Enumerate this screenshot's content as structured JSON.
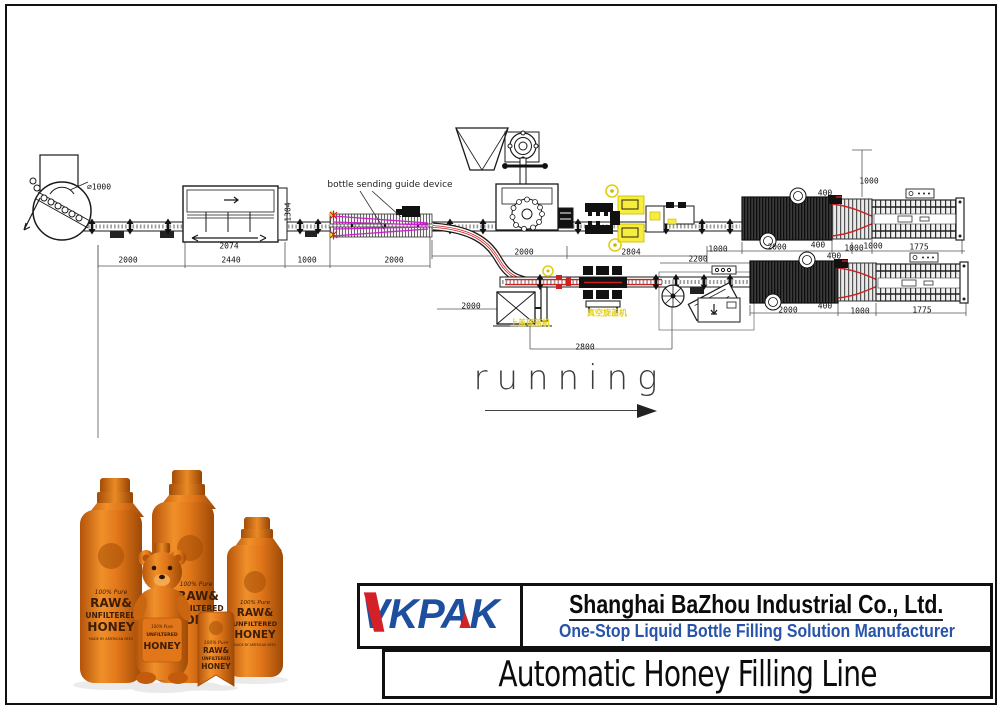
{
  "diagram": {
    "labels": {
      "turntable_diameter": "⌀1000",
      "guide_device": "bottle sending guide device",
      "cap_feeder_cn": "上盖理盖机",
      "vacuum_capper_cn": "真空旋盖机",
      "running": "running"
    },
    "dimensions": [
      {
        "t": "2000",
        "x": 128,
        "y": 260
      },
      {
        "t": "2440",
        "x": 231,
        "y": 260
      },
      {
        "t": "2074",
        "x": 229,
        "y": 246
      },
      {
        "t": "1304",
        "x": 288,
        "y": 212,
        "r": -90
      },
      {
        "t": "1000",
        "x": 307,
        "y": 260
      },
      {
        "t": "2000",
        "x": 394,
        "y": 260
      },
      {
        "t": "2000",
        "x": 524,
        "y": 252
      },
      {
        "t": "2804",
        "x": 631,
        "y": 252
      },
      {
        "t": "2200",
        "x": 698,
        "y": 259
      },
      {
        "t": "1000",
        "x": 718,
        "y": 249
      },
      {
        "t": "2000",
        "x": 777,
        "y": 247
      },
      {
        "t": "400",
        "x": 818,
        "y": 245
      },
      {
        "t": "1000",
        "x": 854,
        "y": 248
      },
      {
        "t": "1000",
        "x": 873,
        "y": 246
      },
      {
        "t": "1775",
        "x": 919,
        "y": 247
      },
      {
        "t": "1000",
        "x": 869,
        "y": 181
      },
      {
        "t": "400",
        "x": 825,
        "y": 193
      },
      {
        "t": "400",
        "x": 834,
        "y": 256
      },
      {
        "t": "2000",
        "x": 788,
        "y": 310
      },
      {
        "t": "400",
        "x": 825,
        "y": 306
      },
      {
        "t": "1000",
        "x": 860,
        "y": 311
      },
      {
        "t": "1775",
        "x": 922,
        "y": 310
      },
      {
        "t": "2800",
        "x": 585,
        "y": 347
      },
      {
        "t": "2000",
        "x": 471,
        "y": 306
      }
    ]
  },
  "product_photo": {
    "pure": "100% Pure",
    "raw": "RAW&",
    "unfiltered": "UNFILTERED",
    "honey": "HONEY",
    "made_by": "MADE BY AMERICAN BEES"
  },
  "branding": {
    "logo_text": "VKPAK",
    "company_name": "Shanghai BaZhou Industrial Co., Ltd.",
    "tagline": "One-Stop Liquid Bottle Filling Solution Manufacturer",
    "product_title": "Automatic Honey Filling Line",
    "colors": {
      "logo_blue": "#1d4f9e",
      "logo_red": "#d42027",
      "tagline_blue": "#2753a8"
    }
  }
}
